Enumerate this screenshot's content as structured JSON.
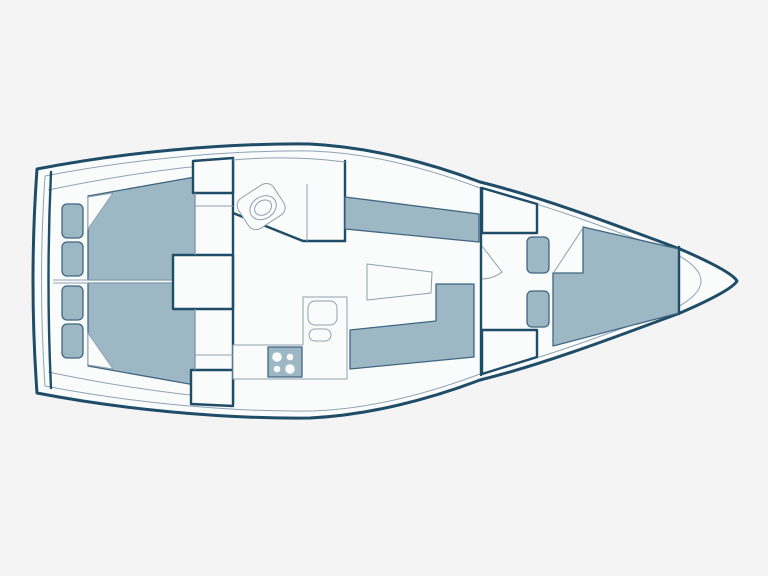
{
  "meta": {
    "type": "sailboat-interior-floor-plan",
    "view": "top-down",
    "orientation": "bow-pointing-right",
    "visible_text": "none"
  },
  "colors": {
    "background": "#f4f4f4",
    "hull_fill": "#fafbfb",
    "furniture_fill": "#9db7c5",
    "furniture_stroke": "#3f6682",
    "wall_stroke": "#1f4d68",
    "deck_line": "#8fa3b3",
    "light_line": "#8fa0ae"
  },
  "rooms": [
    {
      "name": "aft-cabin-port",
      "furniture": [
        "double-berth-with-folded-corner",
        "two-seat-cushions"
      ]
    },
    {
      "name": "aft-cabin-starboard",
      "furniture": [
        "double-berth-with-folded-corner",
        "two-seat-cushions"
      ]
    },
    {
      "name": "companionway",
      "furniture": [
        "step-locker"
      ]
    },
    {
      "name": "head",
      "furniture": [
        "toilet"
      ]
    },
    {
      "name": "galley",
      "furniture": [
        "stove-four-burners",
        "sink",
        "counter"
      ]
    },
    {
      "name": "salon",
      "furniture": [
        "port-settee",
        "l-shaped-starboard-settee",
        "table"
      ]
    },
    {
      "name": "forward-passage",
      "furniture": [
        "hanging-locker-top",
        "hanging-locker-bottom",
        "door-swing",
        "two-seat-cushions"
      ]
    },
    {
      "name": "forward-cabin",
      "furniture": [
        "v-berth-with-folded-corner"
      ]
    }
  ]
}
